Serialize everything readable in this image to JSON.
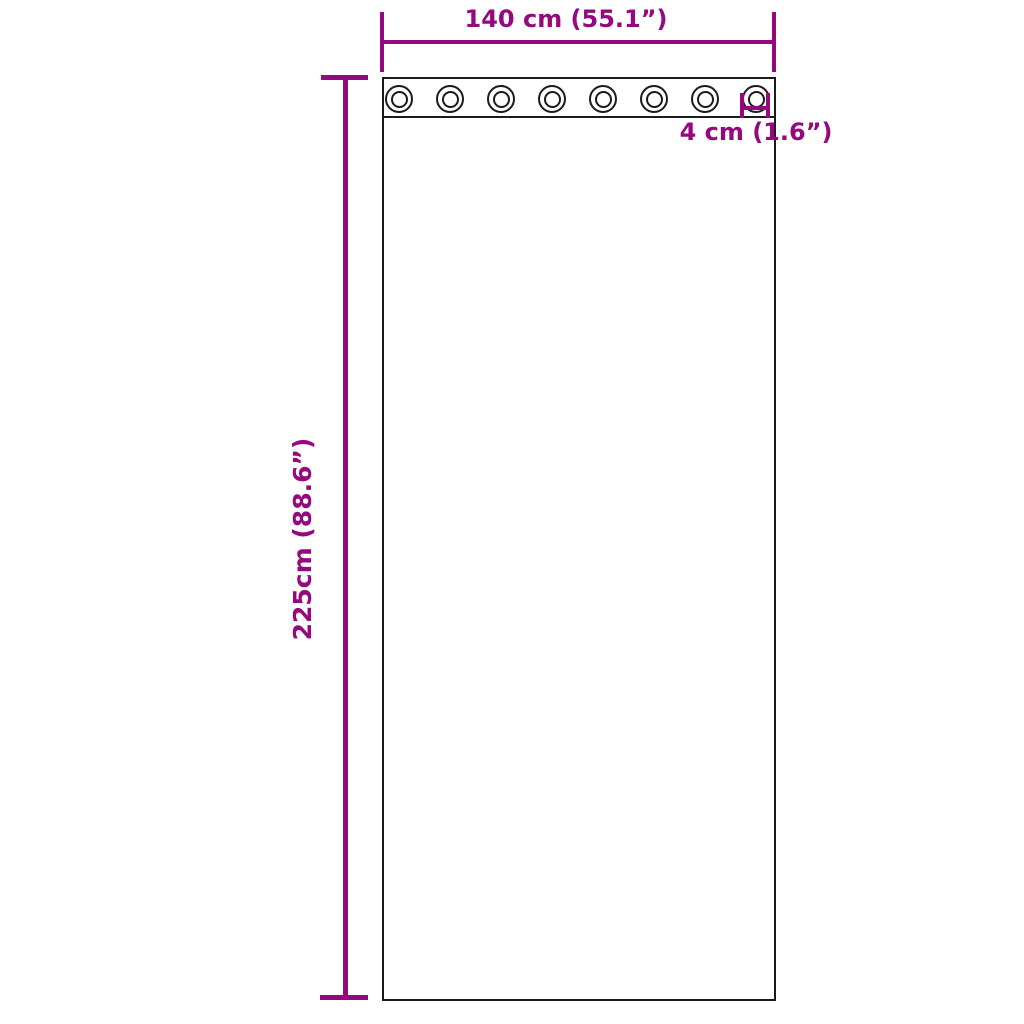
{
  "diagram": {
    "title": "Grommet curtain panel dimension diagram",
    "colors": {
      "dimension": "#96087d",
      "outline": "#1b1b1b",
      "background": "#ffffff"
    },
    "width_label": "140 cm (55.1”)",
    "height_label": "225cm (88.6”)",
    "grommet_label": "4 cm (1.6”)",
    "grommets": {
      "count": 8
    }
  }
}
